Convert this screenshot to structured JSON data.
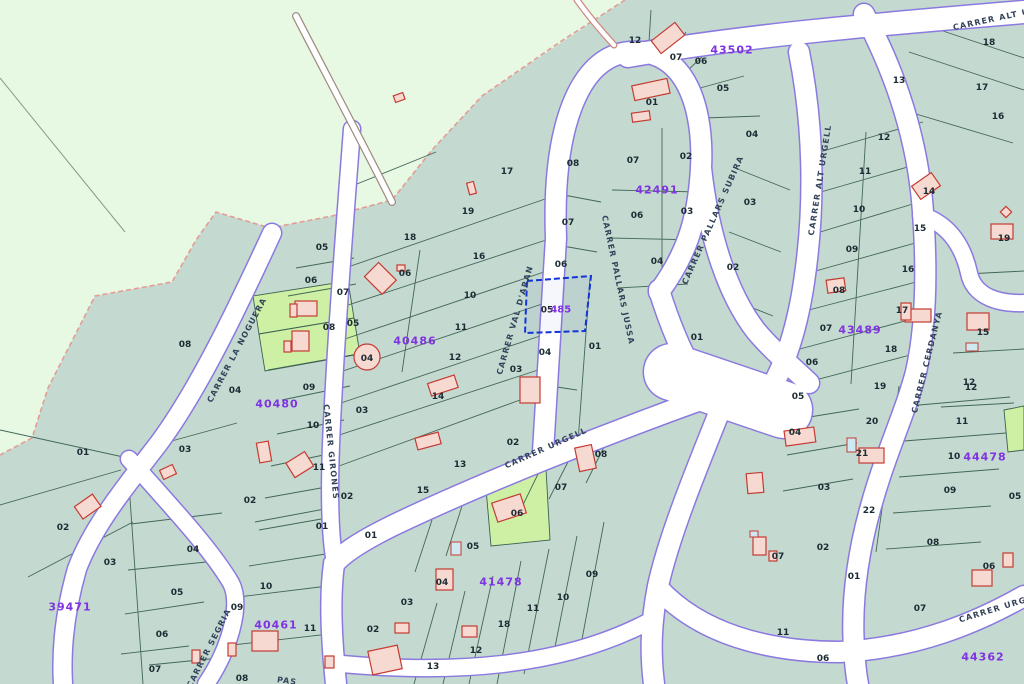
{
  "map": {
    "title": "cadastral-parcel-map",
    "highlight": {
      "parcel_black": "05",
      "block_purple": "485",
      "x": 556,
      "y": 307,
      "outline_color": "#1334d8"
    },
    "colors": {
      "rustic_bg": "#e7f8e3",
      "urban_bg": "#c4d9d0",
      "green_parcel": "#cdf0a4",
      "road_fill": "#ffffff",
      "road_edge": "#8a7ae0",
      "parcel_line": "#3c6152",
      "building_fill": "#f6d9d0",
      "building_stroke": "#c53b33",
      "pool_fill": "#cfe9f2",
      "parcel_text": "#1c2b33",
      "block_text": "#8033e0",
      "street_text": "#33435a",
      "boundary_dash": "#e49c94"
    },
    "street_labels": [
      {
        "text": "CARRER LA NOGUERA",
        "x": 237,
        "y": 350,
        "rot": -62
      },
      {
        "text": "CARRER GIRONES",
        "x": 331,
        "y": 452,
        "rot": 84
      },
      {
        "text": "CARRER VAL D'ARAN",
        "x": 515,
        "y": 320,
        "rot": -74
      },
      {
        "text": "CARRER PALLARS JUSSA",
        "x": 618,
        "y": 280,
        "rot": 78
      },
      {
        "text": "CARRER PALLARS SUBIRA",
        "x": 713,
        "y": 220,
        "rot": -66
      },
      {
        "text": "CARRER ALT URGELL",
        "x": 820,
        "y": 180,
        "rot": -81
      },
      {
        "text": "CARRER ALT URGELL",
        "x": 1008,
        "y": 16,
        "rot": -12
      },
      {
        "text": "CARRER CERDANYA",
        "x": 927,
        "y": 362,
        "rot": -76
      },
      {
        "text": "CARRER URGELL",
        "x": 546,
        "y": 448,
        "rot": -24
      },
      {
        "text": "CARRER URGELL",
        "x": 1002,
        "y": 607,
        "rot": -17
      },
      {
        "text": "CARRER SEGRIA",
        "x": 209,
        "y": 648,
        "rot": -63
      },
      {
        "text": "PAS",
        "x": 287,
        "y": 681,
        "rot": 8
      }
    ],
    "block_labels": [
      {
        "text": "43502",
        "x": 732,
        "y": 50
      },
      {
        "text": "42491",
        "x": 657,
        "y": 190
      },
      {
        "text": "40480",
        "x": 277,
        "y": 404
      },
      {
        "text": "40486",
        "x": 415,
        "y": 341
      },
      {
        "text": "43489",
        "x": 860,
        "y": 330
      },
      {
        "text": "44478",
        "x": 985,
        "y": 457
      },
      {
        "text": "41478",
        "x": 501,
        "y": 582
      },
      {
        "text": "39471",
        "x": 70,
        "y": 607
      },
      {
        "text": "40461",
        "x": 276,
        "y": 625
      },
      {
        "text": "44362",
        "x": 983,
        "y": 657
      }
    ],
    "parcel_numbers": [
      {
        "text": "12",
        "x": 635,
        "y": 41
      },
      {
        "text": "07",
        "x": 676,
        "y": 58
      },
      {
        "text": "06",
        "x": 701,
        "y": 62
      },
      {
        "text": "05",
        "x": 723,
        "y": 89
      },
      {
        "text": "04",
        "x": 752,
        "y": 135
      },
      {
        "text": "02",
        "x": 686,
        "y": 157
      },
      {
        "text": "01",
        "x": 652,
        "y": 103
      },
      {
        "text": "07",
        "x": 633,
        "y": 161
      },
      {
        "text": "06",
        "x": 637,
        "y": 216
      },
      {
        "text": "03",
        "x": 687,
        "y": 212
      },
      {
        "text": "04",
        "x": 657,
        "y": 262
      },
      {
        "text": "02",
        "x": 733,
        "y": 268
      },
      {
        "text": "03",
        "x": 750,
        "y": 203
      },
      {
        "text": "01",
        "x": 697,
        "y": 338
      },
      {
        "text": "08",
        "x": 573,
        "y": 164
      },
      {
        "text": "07",
        "x": 568,
        "y": 223
      },
      {
        "text": "06",
        "x": 561,
        "y": 265
      },
      {
        "text": "04",
        "x": 545,
        "y": 353
      },
      {
        "text": "03",
        "x": 516,
        "y": 370
      },
      {
        "text": "01",
        "x": 595,
        "y": 347
      },
      {
        "text": "17",
        "x": 507,
        "y": 172
      },
      {
        "text": "19",
        "x": 468,
        "y": 212
      },
      {
        "text": "18",
        "x": 410,
        "y": 238
      },
      {
        "text": "16",
        "x": 479,
        "y": 257
      },
      {
        "text": "06",
        "x": 405,
        "y": 274
      },
      {
        "text": "10",
        "x": 470,
        "y": 296
      },
      {
        "text": "11",
        "x": 461,
        "y": 328
      },
      {
        "text": "12",
        "x": 455,
        "y": 358
      },
      {
        "text": "14",
        "x": 438,
        "y": 397
      },
      {
        "text": "13",
        "x": 460,
        "y": 465
      },
      {
        "text": "15",
        "x": 423,
        "y": 491
      },
      {
        "text": "05",
        "x": 353,
        "y": 324
      },
      {
        "text": "05",
        "x": 322,
        "y": 248
      },
      {
        "text": "06",
        "x": 311,
        "y": 281
      },
      {
        "text": "07",
        "x": 343,
        "y": 293
      },
      {
        "text": "08",
        "x": 329,
        "y": 328
      },
      {
        "text": "04",
        "x": 367,
        "y": 359
      },
      {
        "text": "09",
        "x": 309,
        "y": 388
      },
      {
        "text": "10",
        "x": 313,
        "y": 426
      },
      {
        "text": "03",
        "x": 362,
        "y": 411
      },
      {
        "text": "04",
        "x": 235,
        "y": 391
      },
      {
        "text": "08",
        "x": 185,
        "y": 345
      },
      {
        "text": "11",
        "x": 319,
        "y": 468
      },
      {
        "text": "02",
        "x": 250,
        "y": 501
      },
      {
        "text": "02",
        "x": 347,
        "y": 497
      },
      {
        "text": "01",
        "x": 322,
        "y": 527
      },
      {
        "text": "01",
        "x": 371,
        "y": 536
      },
      {
        "text": "10",
        "x": 266,
        "y": 587
      },
      {
        "text": "01",
        "x": 83,
        "y": 453
      },
      {
        "text": "02",
        "x": 63,
        "y": 528
      },
      {
        "text": "03",
        "x": 110,
        "y": 563
      },
      {
        "text": "03",
        "x": 185,
        "y": 450
      },
      {
        "text": "04",
        "x": 193,
        "y": 550
      },
      {
        "text": "05",
        "x": 177,
        "y": 593
      },
      {
        "text": "06",
        "x": 162,
        "y": 635
      },
      {
        "text": "07",
        "x": 155,
        "y": 670
      },
      {
        "text": "09",
        "x": 237,
        "y": 608
      },
      {
        "text": "11",
        "x": 310,
        "y": 629
      },
      {
        "text": "02",
        "x": 373,
        "y": 630
      },
      {
        "text": "08",
        "x": 242,
        "y": 679
      },
      {
        "text": "02",
        "x": 513,
        "y": 443
      },
      {
        "text": "08",
        "x": 601,
        "y": 455
      },
      {
        "text": "07",
        "x": 561,
        "y": 488
      },
      {
        "text": "06",
        "x": 517,
        "y": 514
      },
      {
        "text": "05",
        "x": 473,
        "y": 547
      },
      {
        "text": "04",
        "x": 442,
        "y": 583
      },
      {
        "text": "03",
        "x": 407,
        "y": 603
      },
      {
        "text": "09",
        "x": 592,
        "y": 575
      },
      {
        "text": "10",
        "x": 563,
        "y": 598
      },
      {
        "text": "11",
        "x": 533,
        "y": 609
      },
      {
        "text": "18",
        "x": 504,
        "y": 625
      },
      {
        "text": "12",
        "x": 476,
        "y": 651
      },
      {
        "text": "13",
        "x": 433,
        "y": 667
      },
      {
        "text": "11",
        "x": 865,
        "y": 172
      },
      {
        "text": "10",
        "x": 859,
        "y": 210
      },
      {
        "text": "09",
        "x": 852,
        "y": 250
      },
      {
        "text": "08",
        "x": 839,
        "y": 291
      },
      {
        "text": "07",
        "x": 826,
        "y": 329
      },
      {
        "text": "06",
        "x": 812,
        "y": 363
      },
      {
        "text": "14",
        "x": 929,
        "y": 192
      },
      {
        "text": "15",
        "x": 920,
        "y": 229
      },
      {
        "text": "16",
        "x": 908,
        "y": 270
      },
      {
        "text": "17",
        "x": 902,
        "y": 311
      },
      {
        "text": "18",
        "x": 891,
        "y": 350
      },
      {
        "text": "19",
        "x": 1004,
        "y": 239
      },
      {
        "text": "15",
        "x": 983,
        "y": 333
      },
      {
        "text": "12",
        "x": 969,
        "y": 383
      },
      {
        "text": "13",
        "x": 899,
        "y": 81
      },
      {
        "text": "12",
        "x": 884,
        "y": 138
      },
      {
        "text": "18",
        "x": 989,
        "y": 43
      },
      {
        "text": "17",
        "x": 982,
        "y": 88
      },
      {
        "text": "16",
        "x": 998,
        "y": 117
      },
      {
        "text": "05",
        "x": 798,
        "y": 397
      },
      {
        "text": "19",
        "x": 880,
        "y": 387
      },
      {
        "text": "04",
        "x": 795,
        "y": 433
      },
      {
        "text": "20",
        "x": 872,
        "y": 422
      },
      {
        "text": "21",
        "x": 862,
        "y": 454
      },
      {
        "text": "12",
        "x": 971,
        "y": 388
      },
      {
        "text": "11",
        "x": 962,
        "y": 422
      },
      {
        "text": "10",
        "x": 954,
        "y": 457
      },
      {
        "text": "03",
        "x": 824,
        "y": 488
      },
      {
        "text": "22",
        "x": 869,
        "y": 511
      },
      {
        "text": "09",
        "x": 950,
        "y": 491
      },
      {
        "text": "02",
        "x": 823,
        "y": 548
      },
      {
        "text": "01",
        "x": 854,
        "y": 577
      },
      {
        "text": "08",
        "x": 933,
        "y": 543
      },
      {
        "text": "07",
        "x": 920,
        "y": 609
      },
      {
        "text": "06",
        "x": 989,
        "y": 567
      },
      {
        "text": "11",
        "x": 783,
        "y": 633
      },
      {
        "text": "06",
        "x": 823,
        "y": 659
      },
      {
        "text": "07",
        "x": 778,
        "y": 557
      },
      {
        "text": "05",
        "x": 1015,
        "y": 497
      }
    ]
  }
}
